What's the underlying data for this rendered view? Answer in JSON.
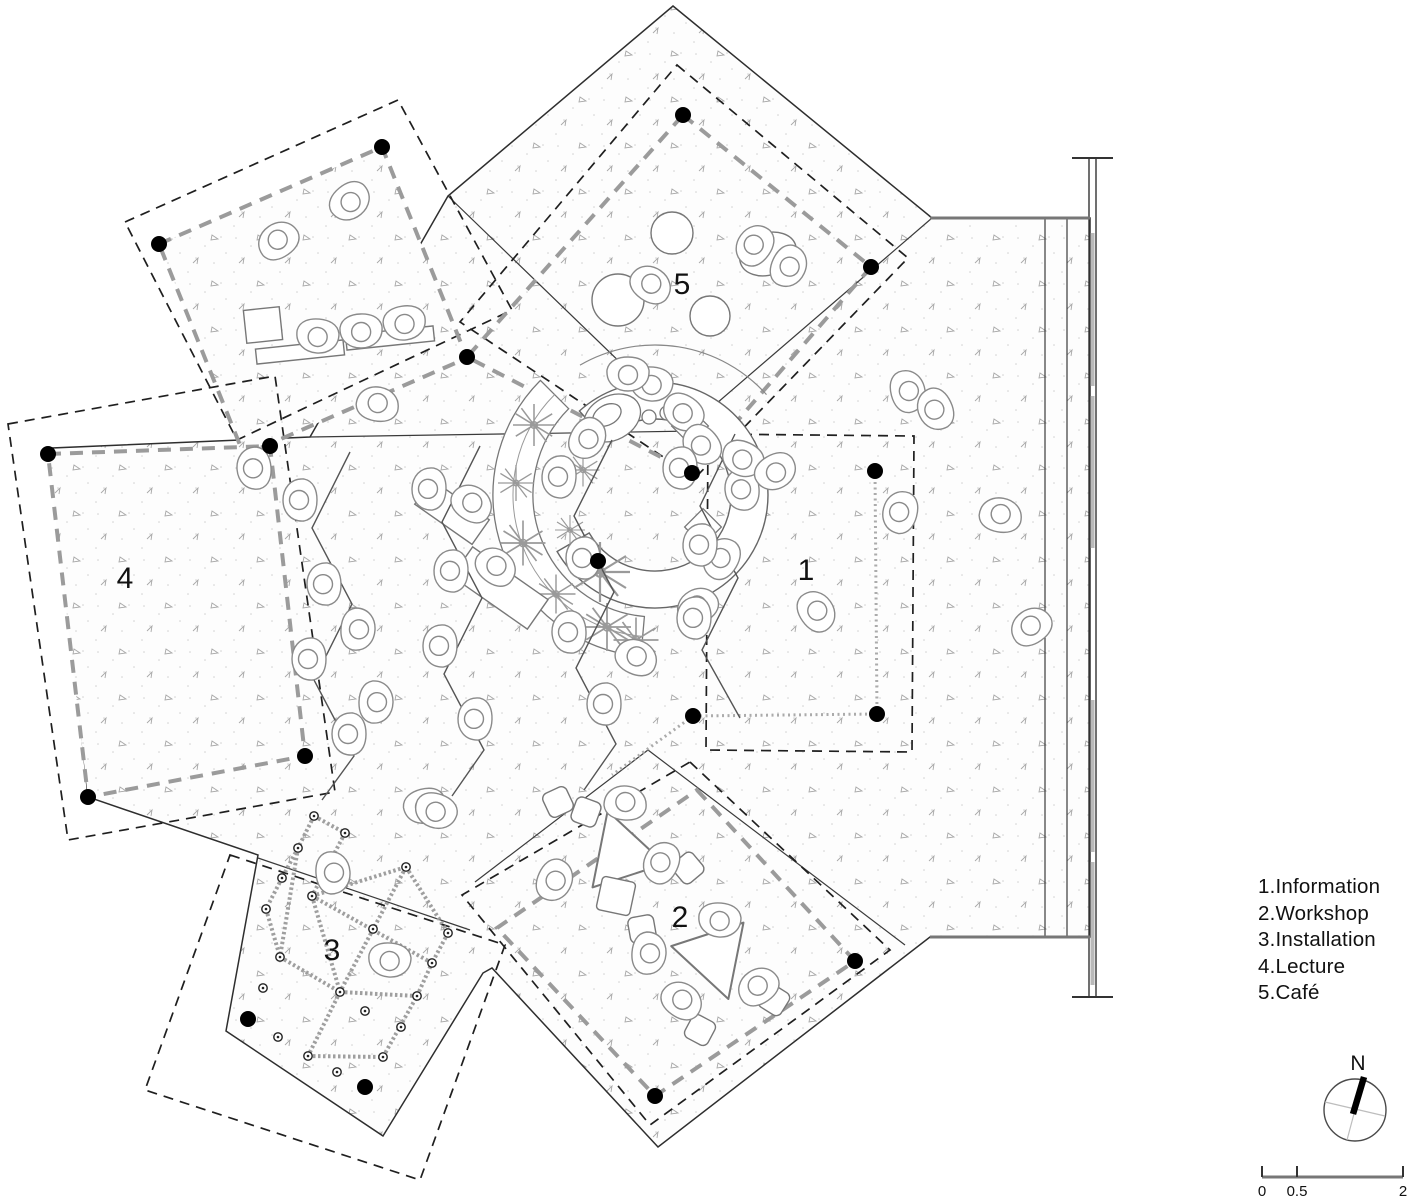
{
  "page": {
    "type": "architectural floor plan",
    "background": "#ffffff"
  },
  "legend": {
    "items": [
      {
        "label": "1.Information"
      },
      {
        "label": "2.Workshop"
      },
      {
        "label": "3.Installation"
      },
      {
        "label": "4.Lecture"
      },
      {
        "label": "5.Café"
      }
    ]
  },
  "zones": [
    {
      "id": "1",
      "name": "Information",
      "label": "1"
    },
    {
      "id": "2",
      "name": "Workshop",
      "label": "2"
    },
    {
      "id": "3",
      "name": "Installation",
      "label": "3"
    },
    {
      "id": "4",
      "name": "Lecture",
      "label": "4"
    },
    {
      "id": "5",
      "name": "Café",
      "label": "5"
    }
  ],
  "compass": {
    "north_label": "N"
  },
  "scale_bar": {
    "tick_labels": [
      "0",
      "0.5",
      "2"
    ]
  },
  "colors": {
    "wall": "#2e2e2e",
    "zone_boundary_dash": "#1f1f1f",
    "rug_dash": "#9b9b9b",
    "column_dot": "#000000",
    "figure_outline": "#8a8a8a",
    "stipple_dot": "#cfcfcf"
  }
}
